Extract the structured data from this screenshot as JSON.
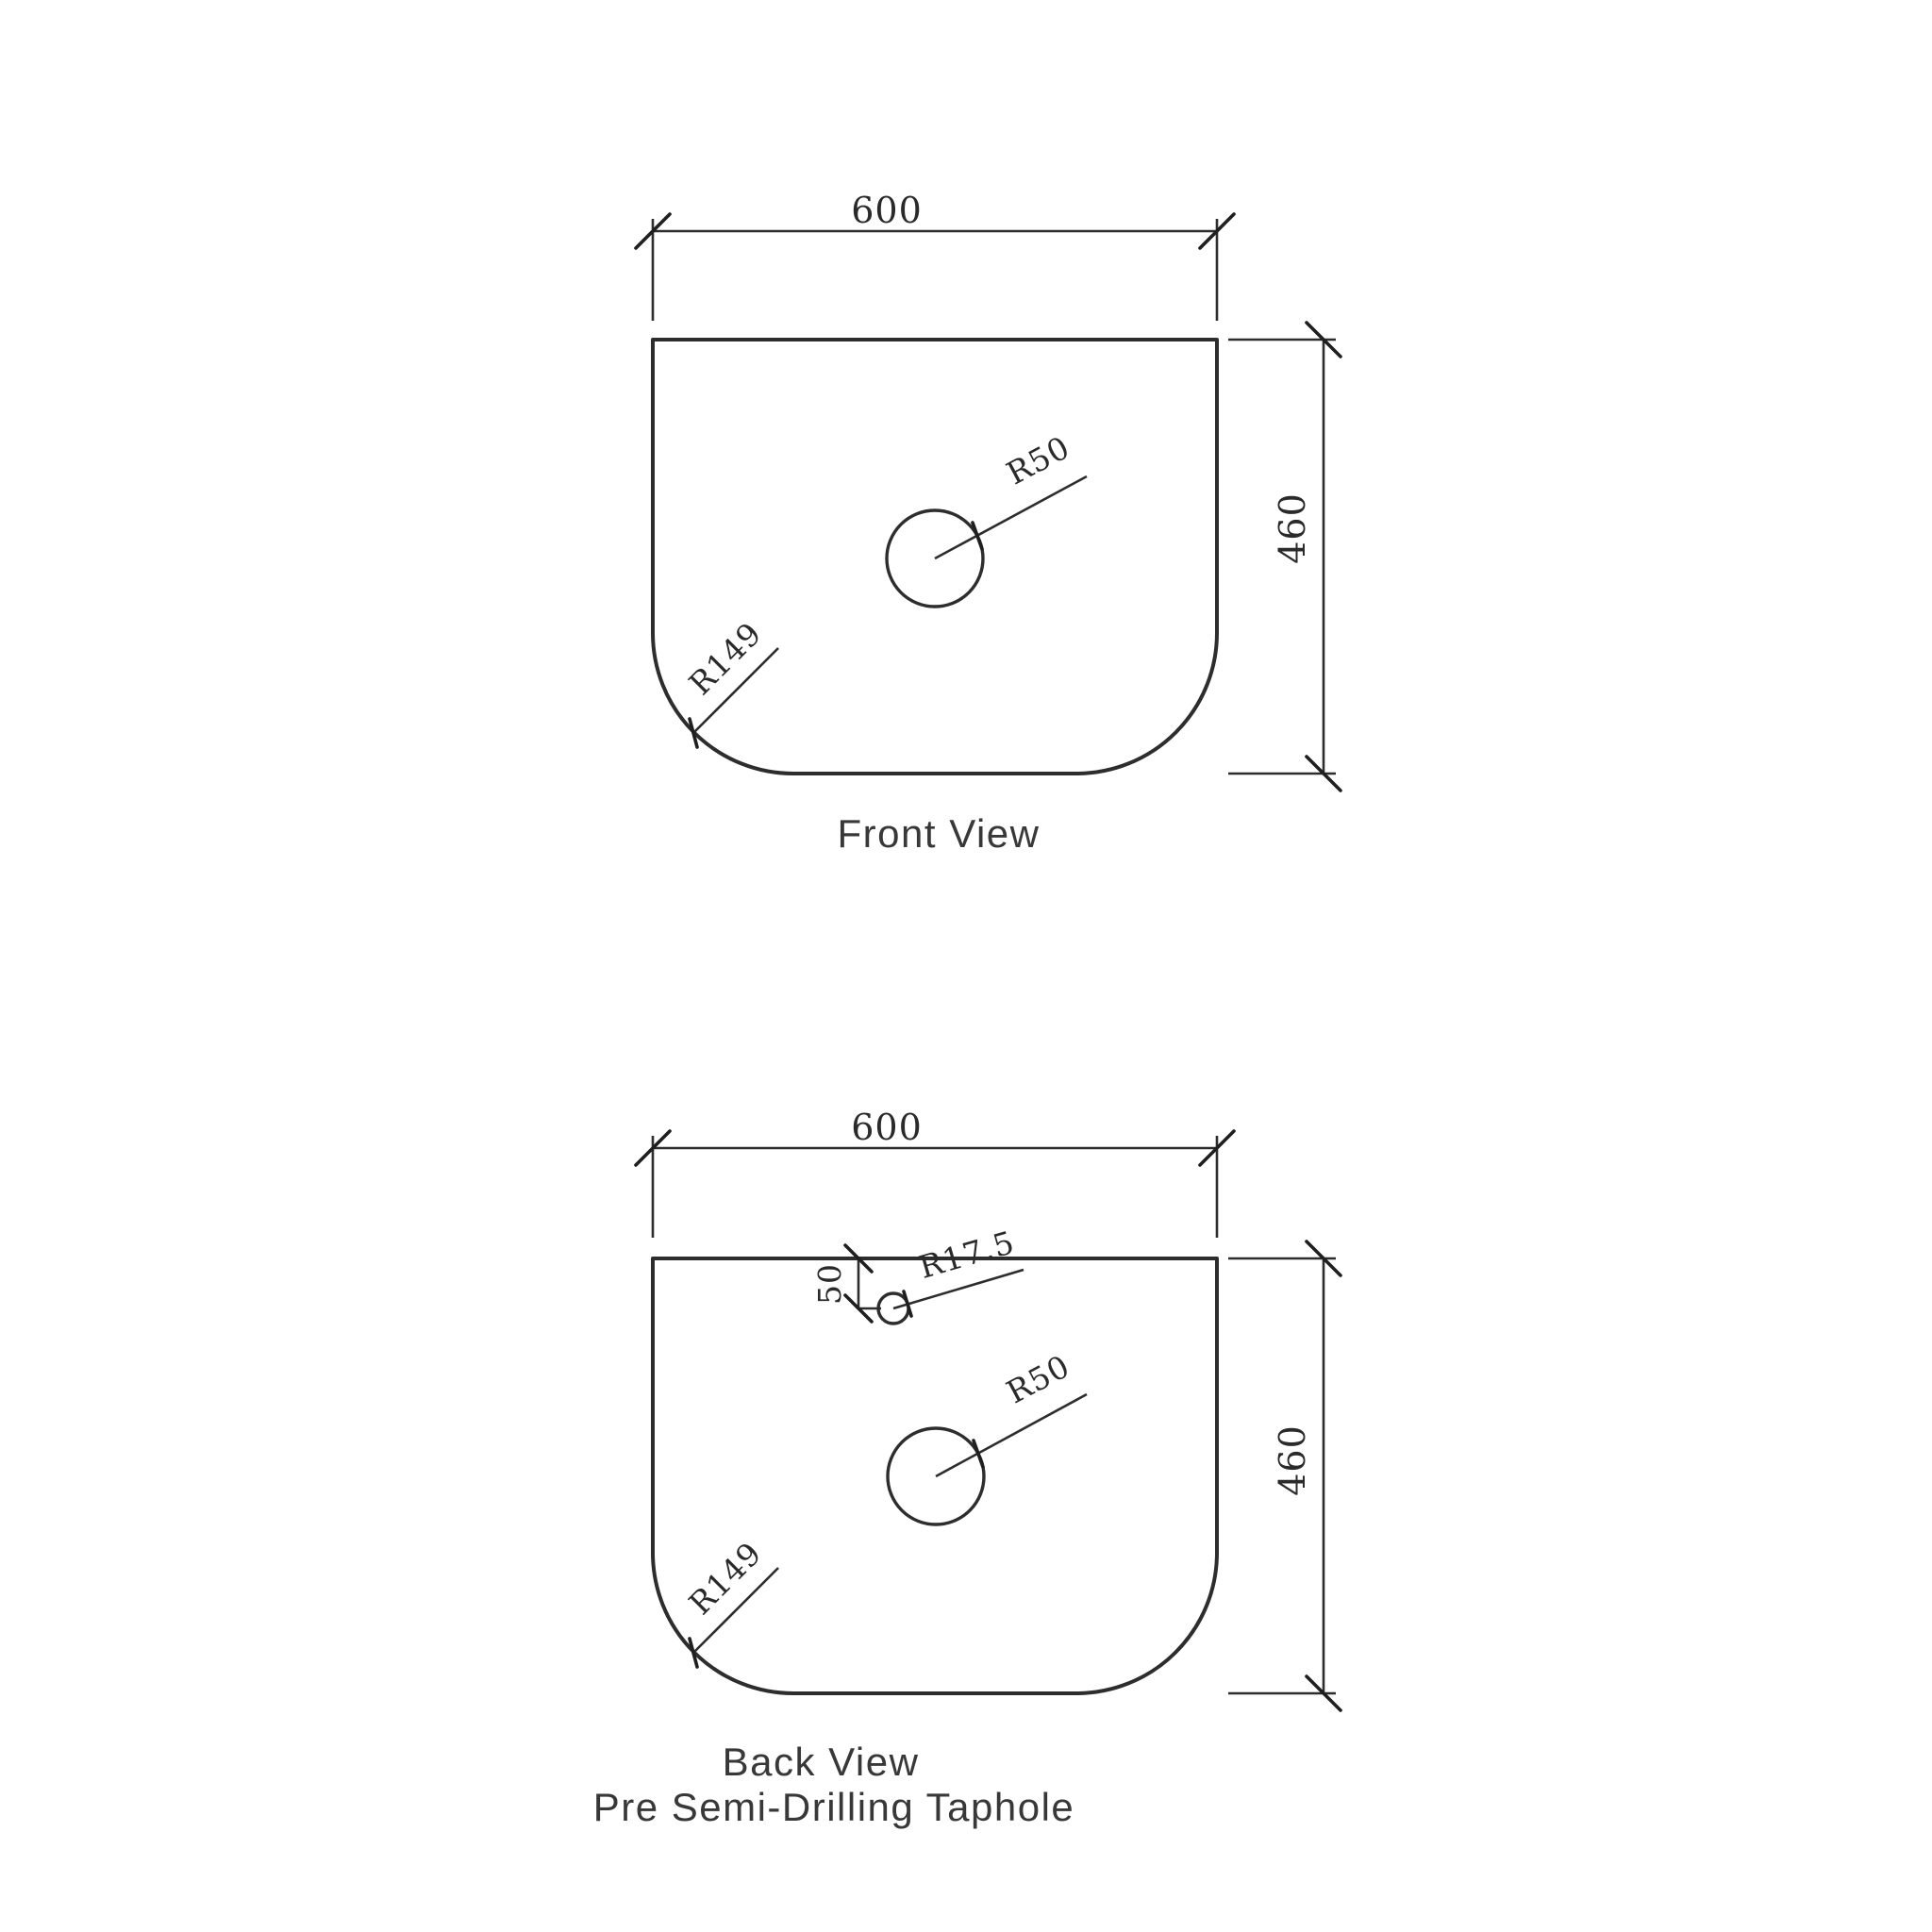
{
  "document": {
    "background_color": "#ffffff",
    "line_color": "#2d2d2d",
    "text_color": "#383838",
    "type": "technical-drawing",
    "subject": "basin-top outline with taphole positions"
  },
  "front_view": {
    "caption": "Front View",
    "dims": {
      "width": "600",
      "height": "460",
      "basin_hole_radius": "R50",
      "corner_radius": "R149"
    }
  },
  "back_view": {
    "caption_line1": "Back View",
    "caption_line2": "Pre Semi-Drilling Taphole",
    "dims": {
      "width": "600",
      "height": "460",
      "basin_hole_radius": "R50",
      "corner_radius": "R149",
      "taphole_radius": "R17.5",
      "taphole_offset_from_top": "50"
    }
  }
}
